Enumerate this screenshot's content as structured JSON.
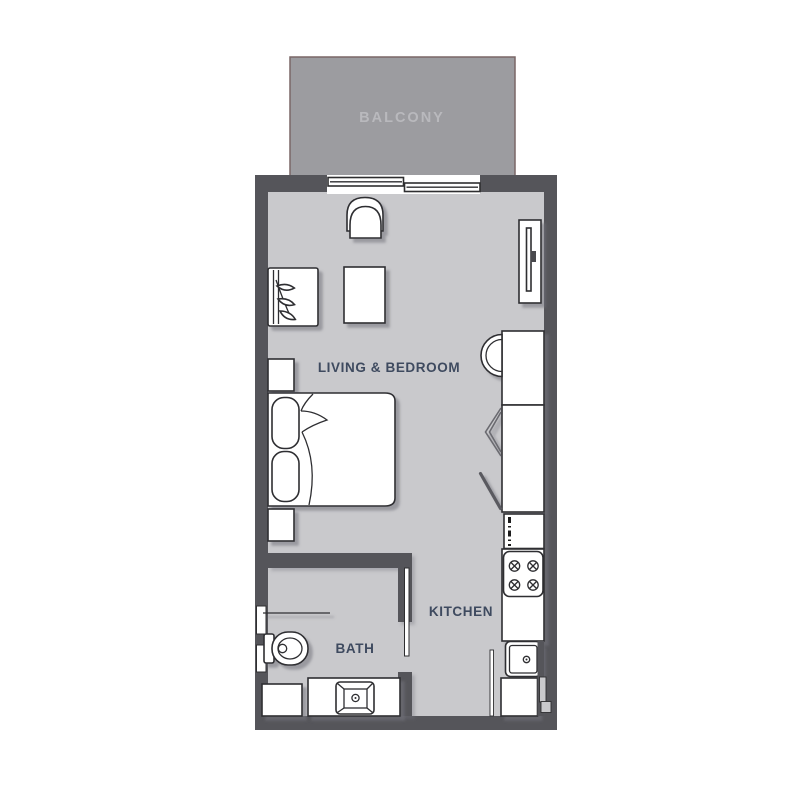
{
  "rooms": {
    "balcony": {
      "label": "BALCONY"
    },
    "living_bedroom": {
      "label": "LIVING & BEDROOM"
    },
    "kitchen": {
      "label": "KITCHEN"
    },
    "bath": {
      "label": "BATH"
    }
  },
  "fixtures": [
    "balcony-sliding-door",
    "lounge-chair",
    "armchair-with-plant",
    "side-table",
    "wall-tv",
    "nightstand",
    "double-bed",
    "kitchen-counter",
    "wash-basin",
    "open-cabinet-doors",
    "dishwasher",
    "stove-4-burner",
    "kitchen-sink",
    "base-cabinet",
    "pocket-door",
    "toilet",
    "shower-screen",
    "shower-tray",
    "vanity-sink"
  ],
  "colors": {
    "floor": "#c9c9cc",
    "wall": "#55555a",
    "balcony_fill": "#9c9ca0",
    "balcony_border": "#7a6767",
    "balcony_text": "#b9b9bd",
    "label_text": "#3e4a5f",
    "furniture_outline": "#2e2e30",
    "furniture_fill": "#ffffff",
    "door_line": "#5a5a60",
    "background": "#ffffff"
  }
}
